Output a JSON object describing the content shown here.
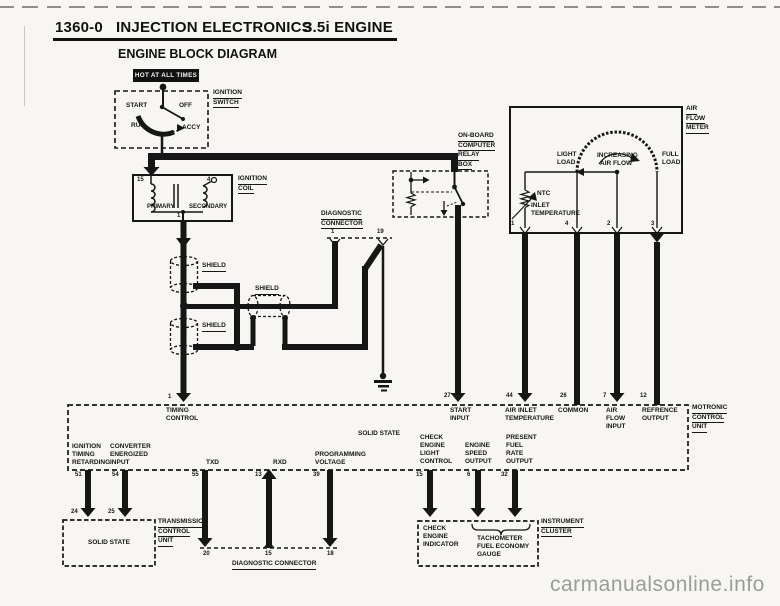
{
  "colors": {
    "ink": "#161616",
    "paper": "#f7f6f2",
    "watermark": "#9b9b9b"
  },
  "header": {
    "page_code": "1360-0",
    "title": "INJECTION ELECTRONICS",
    "engine": "3.5i ENGINE",
    "subtitle": "ENGINE BLOCK DIAGRAM"
  },
  "power": {
    "hot_label": "HOT AT ALL TIMES"
  },
  "ignition_switch": {
    "label_lines": [
      "IGNITION",
      "SWITCH"
    ],
    "start": "START",
    "off": "OFF",
    "run": "RUN",
    "accy": "ACCY"
  },
  "ignition_coil": {
    "label_lines": [
      "IGNITION",
      "COIL"
    ],
    "pin_left": "15",
    "pin_right": "4",
    "pin_bottom": "1",
    "primary": "PRIMARY",
    "secondary": "SECONDARY"
  },
  "shield": {
    "label": "SHIELD"
  },
  "diag_top": {
    "label_lines": [
      "DIAGNOSTIC",
      "CONNECTOR"
    ],
    "pins": [
      "1",
      "19"
    ]
  },
  "relay_box": {
    "label_lines": [
      "ON-BOARD",
      "COMPUTER",
      "RELAY",
      "BOX"
    ]
  },
  "air_flow_meter": {
    "label_lines": [
      "AIR",
      "FLOW",
      "METER"
    ],
    "light_load_lines": [
      "LIGHT",
      "LOAD"
    ],
    "increasing_lines": [
      "INCREASING",
      "AIR FLOW"
    ],
    "full_load_lines": [
      "FULL",
      "LOAD"
    ],
    "ntc": "NTC",
    "inlet_lines": [
      "INLET",
      "TEMPERATURE"
    ],
    "pins": [
      "1",
      "4",
      "2",
      "3"
    ]
  },
  "motronic": {
    "label_lines": [
      "MOTRONIC",
      "CONTROL",
      "UNIT"
    ],
    "solid_state": "SOLID STATE",
    "top_pins": [
      {
        "num": "1",
        "lines": [
          "TIMING",
          "CONTROL"
        ]
      },
      {
        "num": "27",
        "lines": [
          "START",
          "INPUT"
        ]
      },
      {
        "num": "44",
        "lines": [
          "AIR INLET",
          "TEMPERATURE"
        ]
      },
      {
        "num": "26",
        "lines": [
          "COMMON"
        ]
      },
      {
        "num": "7",
        "lines": [
          "AIR",
          "FLOW",
          "INPUT"
        ]
      },
      {
        "num": "12",
        "lines": [
          "REFRENCE",
          "OUTPUT"
        ]
      }
    ],
    "bottom_pins": [
      {
        "num": "51",
        "lines": [
          "IGNITION",
          "TIMING",
          "RETARDING"
        ]
      },
      {
        "num": "54",
        "lines": [
          "CONVERTER",
          "ENERGIZED",
          "INPUT"
        ]
      },
      {
        "num": "55",
        "lines": [
          "TXD"
        ]
      },
      {
        "num": "13",
        "lines": [
          "RXD"
        ]
      },
      {
        "num": "39",
        "lines": [
          "PROGRAMMING",
          "VOLTAGE"
        ]
      },
      {
        "num": "15",
        "lines": [
          "CHECK",
          "ENGINE",
          "LIGHT",
          "CONTROL"
        ]
      },
      {
        "num": "6",
        "lines": [
          "ENGINE",
          "SPEED",
          "OUTPUT"
        ]
      },
      {
        "num": "32",
        "lines": [
          "PRESENT",
          "FUEL",
          "RATE",
          "OUTPUT"
        ]
      }
    ]
  },
  "transmission_unit": {
    "label_lines": [
      "TRANSMISSION",
      "CONTROL",
      "UNIT"
    ],
    "solid_state": "SOLID STATE",
    "pins": [
      "24",
      "25"
    ]
  },
  "diag_bottom": {
    "label": "DIAGNOSTIC CONNECTOR",
    "pins": [
      "20",
      "15",
      "18"
    ]
  },
  "instrument_cluster": {
    "label_lines": [
      "INSTRUMENT",
      "CLUSTER"
    ],
    "check_lines": [
      "CHECK",
      "ENGINE",
      "INDICATOR"
    ],
    "gauge_lines": [
      "TACHOMETER",
      "FUEL ECONOMY",
      "GAUGE"
    ]
  },
  "watermark": "carmanualsonline.info"
}
